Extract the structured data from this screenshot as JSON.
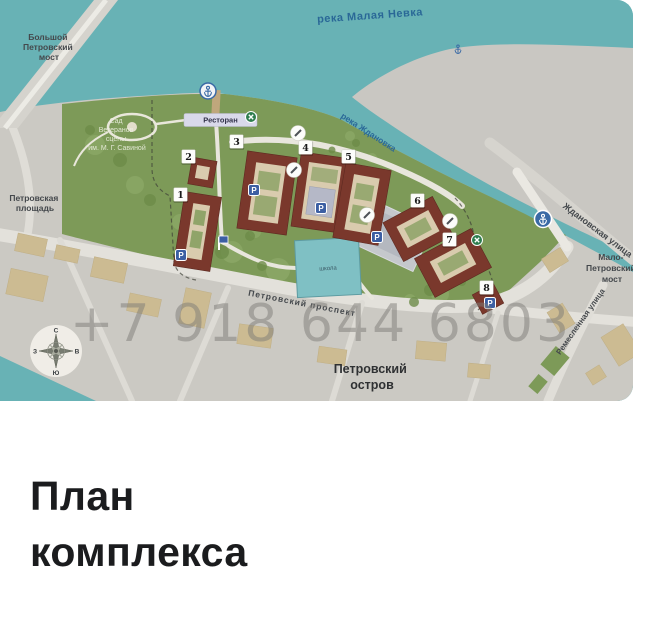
{
  "map": {
    "watermark": "+7 918 644 6803",
    "labels": {
      "river_top": "река Малая Невка",
      "bridge_nw": {
        "lines": [
          "Большой",
          "Петровский",
          "мост"
        ]
      },
      "square_w": {
        "lines": [
          "Петровская",
          "площадь"
        ]
      },
      "garden": {
        "lines": [
          "Сад",
          "Ветеранов",
          "сцены",
          "им. М. Г. Савиной"
        ]
      },
      "restaurant": "Ресторан",
      "river_e": "река Ждановка",
      "street_zhdanovskaya": "Ждановская улица",
      "bridge_se": {
        "lines": [
          "Мало-",
          "Петровский",
          "мост"
        ]
      },
      "street_remeslennaya": "Ремесленная улица",
      "avenue": "Петровский проспект",
      "island": {
        "lines": [
          "Петровский",
          "остров"
        ]
      },
      "school": "школа"
    },
    "buildings": [
      {
        "number": "1"
      },
      {
        "number": "2"
      },
      {
        "number": "3"
      },
      {
        "number": "4"
      },
      {
        "number": "5"
      },
      {
        "number": "6"
      },
      {
        "number": "7"
      },
      {
        "number": "8"
      }
    ],
    "compass": {
      "n": "С",
      "e": "В",
      "s": "Ю",
      "w": "З"
    },
    "colors": {
      "water": "#68b2b5",
      "far_land": "#c9c7c2",
      "park_green": "#7d9a58",
      "ground": "#cbc9c3",
      "building_red": "#7a382c",
      "tan_building": "#ccbb92",
      "school_teal": "#7fc0c4",
      "marker_blue": "#3c5fa3",
      "label_blue": "#2a6897",
      "watermark_gray": "#7e7c78"
    }
  },
  "section": {
    "title": "План комплекса"
  }
}
